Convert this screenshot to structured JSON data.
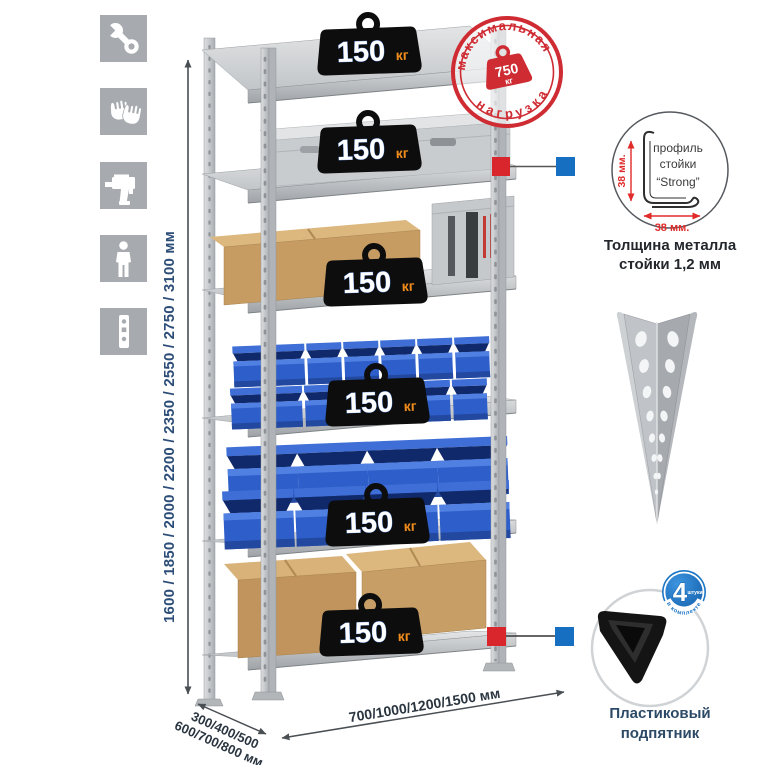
{
  "colors": {
    "accent_red": "#d8262c",
    "accent_blue": "#176fc1",
    "stamp_red": "#cf2b33",
    "navy": "#2c4d78",
    "orange": "#f08c1c",
    "bin_blue": "#2d5ec9",
    "badge_blue": "#1b74c4",
    "metal_gray": "#c7cacd",
    "icon_tile_gray": "#a7abaf"
  },
  "sidebar": {
    "icons": [
      {
        "name": "wrench-icon"
      },
      {
        "name": "gloves-icon"
      },
      {
        "name": "drill-icon"
      },
      {
        "name": "person-icon"
      },
      {
        "name": "rack-profile-icon"
      }
    ]
  },
  "dimensions": {
    "height": "1600 / 1850 / 2000 / 2200 / 2350 / 2550 / 2750 / 3100 мм",
    "depth_line1": "300/400/500",
    "depth_line2": "600/700/800 мм",
    "width": "700/1000/1200/1500 мм"
  },
  "rack": {
    "shelf_badges": [
      {
        "value": "150",
        "unit": "кг"
      },
      {
        "value": "150",
        "unit": "кг"
      },
      {
        "value": "150",
        "unit": "кг"
      },
      {
        "value": "150",
        "unit": "кг"
      },
      {
        "value": "150",
        "unit": "кг"
      },
      {
        "value": "150",
        "unit": "кг"
      }
    ]
  },
  "stamp": {
    "arc_top": "максимальная",
    "arc_bottom": "нагрузка",
    "value": "750",
    "unit": "кг"
  },
  "profile_detail": {
    "line1": "профиль",
    "line2": "стойки",
    "line3": "“Strong”",
    "dim_vertical": "38 мм.",
    "dim_horizontal": "38 мм.",
    "caption1": "Толщина металла",
    "caption2": "стойки 1,2 мм"
  },
  "foot_detail": {
    "badge_value": "4",
    "badge_word": "штуки",
    "badge_arc": "в комплекте",
    "caption1": "Пластиковый",
    "caption2": "подпятник"
  }
}
